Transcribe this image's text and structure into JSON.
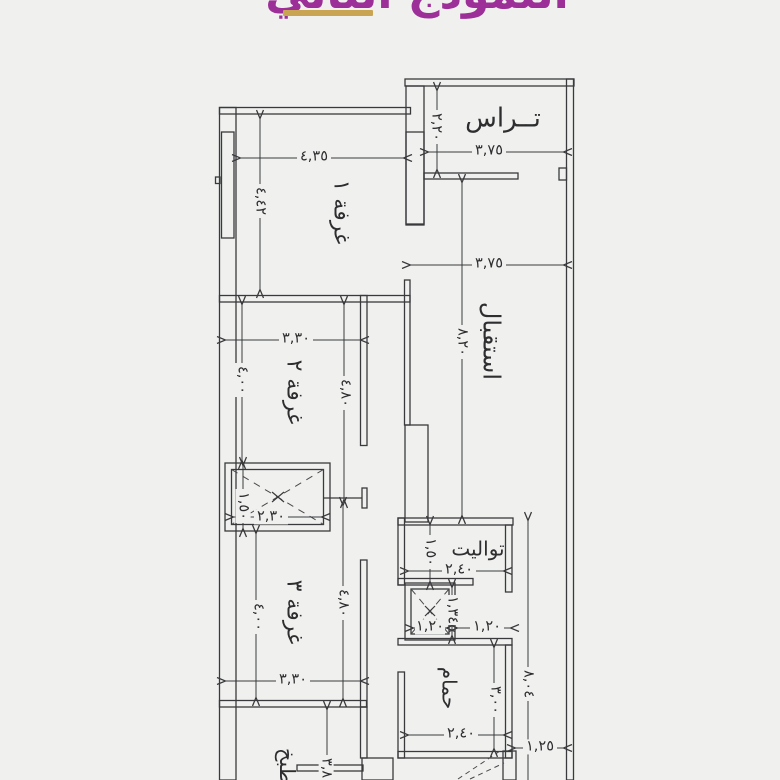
{
  "page": {
    "background": "#f0f1ef",
    "line_color": "#3a3a3c"
  },
  "title": {
    "text": "النموذج الثاني",
    "color": "#9c2f98",
    "underline_color": "#c9a452"
  },
  "plan": {
    "rooms": {
      "terrace": {
        "label": "تــراس",
        "width": "٣,٧٥",
        "height": "٢,٢٠"
      },
      "room1": {
        "label": "غرفة ١",
        "width": "٤,٣٥",
        "height": "٤,٤٢"
      },
      "reception": {
        "label": "استقبال",
        "width": "٣,٧٥",
        "height": "٨,٢٠"
      },
      "room2": {
        "label": "غرفة ٢",
        "width": "٣,٣٠",
        "height_left": "٤,٠٠",
        "height_right": "٤,٨٠"
      },
      "closet": {
        "width": "٢,٣٠",
        "height": "١,٥٠"
      },
      "room3": {
        "label": "غرفة ٣",
        "width": "٣,٣٠",
        "height_left": "٤,٠٠",
        "height_right": "٤,٨٠"
      },
      "toilet": {
        "label": "تواليت",
        "width": "٢,٤٠",
        "height": "١,٥٠"
      },
      "duct": {
        "width": "١,٢٠",
        "height": "١,٣٤"
      },
      "corridor": {
        "width": "١,٢٠"
      },
      "bathroom": {
        "label": "حمام",
        "width": "٢,٤٠",
        "height": "٣,٠٠"
      },
      "kitchen": {
        "label": "مطبخ",
        "height": "٣,٨٠"
      },
      "side": {
        "total_height": "٨,٠٤",
        "passage_width": "١,٢٥"
      }
    }
  }
}
